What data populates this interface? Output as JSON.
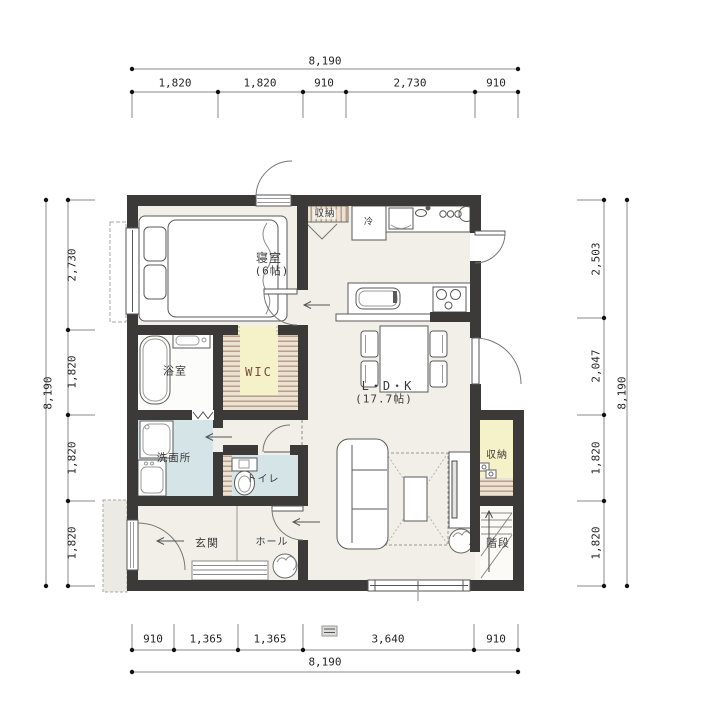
{
  "rooms": {
    "bedroom": {
      "label": "寝室",
      "size": "(6帖)"
    },
    "ldk": {
      "label": "L・D・K",
      "size": "(17.7帖)"
    },
    "bathroom": {
      "label": "浴室"
    },
    "wic": {
      "label": "WIC"
    },
    "washroom": {
      "label": "洗面所"
    },
    "toilet": {
      "label": "トイレ"
    },
    "genkan": {
      "label": "玄関"
    },
    "hall": {
      "label": "ホール"
    },
    "storage_top": {
      "label": "収納"
    },
    "storage_right": {
      "label": "収納"
    },
    "stairs": {
      "label": "階段"
    }
  },
  "fixtures": {
    "fridge": "冷"
  },
  "dimensions": {
    "top": {
      "total": "8,190",
      "segments": [
        "1,820",
        "1,820",
        "910",
        "2,730",
        "910"
      ]
    },
    "bottom": {
      "total": "8,190",
      "segments": [
        "910",
        "1,365",
        "1,365",
        "3,640",
        "910"
      ]
    },
    "left": {
      "total": "8,190",
      "segments": [
        "2,730",
        "1,820",
        "1,820",
        "1,820"
      ]
    },
    "right": {
      "total": "8,190",
      "segments": [
        "2,503",
        "2,047",
        "1,820",
        "1,820"
      ]
    }
  },
  "colors": {
    "wall": "#3b3a38",
    "floor": "#f1efe8",
    "wet_room": "#d5e4e7",
    "closet": "#f5f1c8",
    "shelf_stripe": "#b1947a",
    "outline": "#555555"
  }
}
